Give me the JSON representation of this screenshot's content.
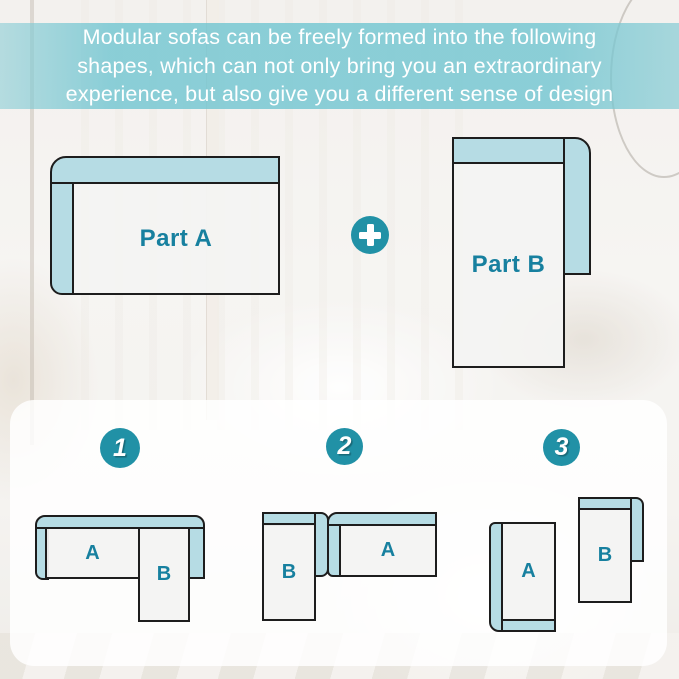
{
  "banner": {
    "lines": [
      "Modular sofas can be freely formed into the following",
      "shapes, which can not only bring you an extraordinary",
      "experience, but also give you a different sense of design"
    ]
  },
  "parts": {
    "part_a_label": "Part A",
    "part_b_label": "Part B"
  },
  "icons": {
    "plus_icon": "plus"
  },
  "combinations": [
    {
      "number": "1",
      "labels": {
        "a": "A",
        "b": "B"
      }
    },
    {
      "number": "2",
      "labels": {
        "a": "A",
        "b": "B"
      }
    },
    {
      "number": "3",
      "labels": {
        "a": "A",
        "b": "B"
      }
    }
  ],
  "colors": {
    "banner_teal": "#6dc4d0",
    "accent_teal": "#2191a6",
    "label_teal": "#17809f",
    "cushion_blue": "#b6dce4",
    "seat_gray": "#f3f3f2",
    "outline": "#1d1d1d",
    "panel_white": "#ffffff"
  }
}
